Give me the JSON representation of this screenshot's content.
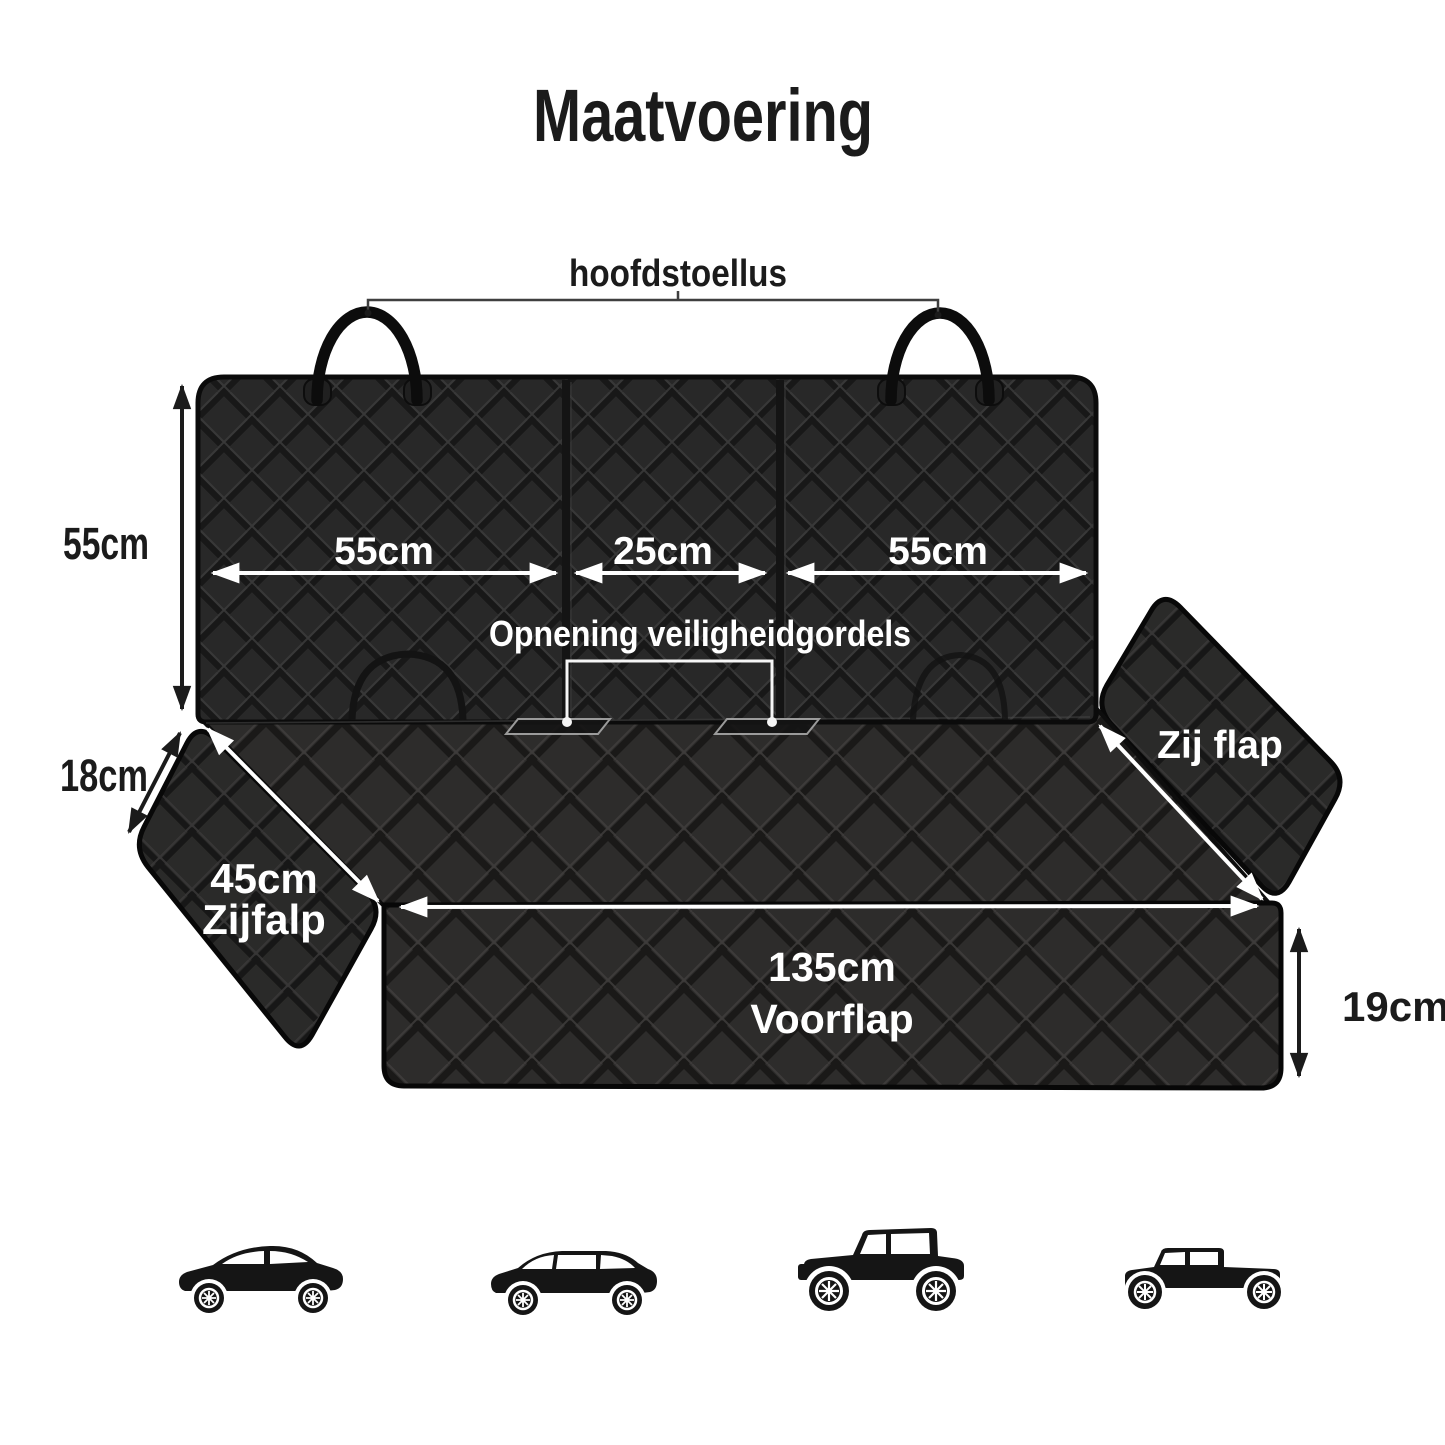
{
  "page": {
    "title": "Maatvoering",
    "background": "#ffffff"
  },
  "colors": {
    "fabric_backrest": "#282828",
    "fabric_seat": "#2d2c2b",
    "fabric_flaps": "#2a2a29",
    "stitch_shadow": "#181818",
    "stitch_highlight": "#3c3c3c",
    "binding_edge": "#070707",
    "annotation_white": "#ffffff",
    "annotation_black": "#1b1b1b",
    "vehicle_silhouette": "#151515"
  },
  "cover": {
    "headrest_loop_label": "hoofdstoellus",
    "backrest_height": "55cm",
    "backrest_panels": {
      "left": "55cm",
      "middle": "25cm",
      "right": "55cm"
    },
    "seatbelt_opening_label": "Opnening veiligheidgordels",
    "left_flap": {
      "depth": "18cm",
      "size": "45cm",
      "name": "Zijfalp"
    },
    "right_flap": {
      "name": "Zij flap"
    },
    "front_flap": {
      "width": "135cm",
      "name": "Voorflap",
      "height": "19cm"
    }
  },
  "vehicles": [
    "sedan",
    "station-wagon",
    "jeep",
    "pickup-truck"
  ]
}
